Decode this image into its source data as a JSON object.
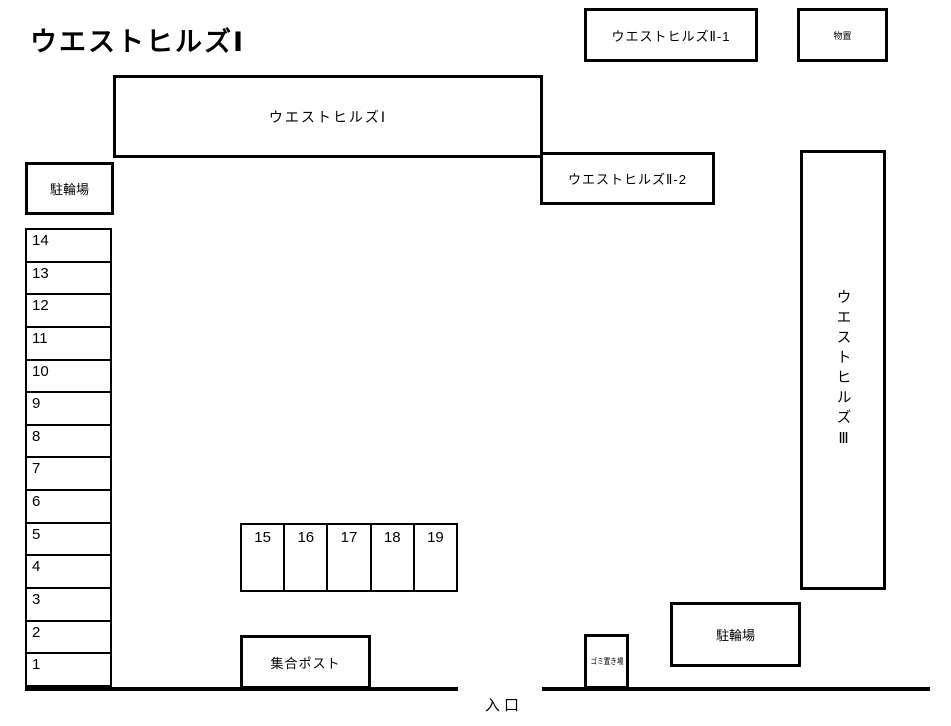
{
  "page": {
    "title": "ウエストヒルズⅠ"
  },
  "buildings": {
    "main": {
      "label": "ウエストヒルズⅠ"
    },
    "annex_2_1": {
      "label": "ウエストヒルズⅡ-1"
    },
    "annex_2_2": {
      "label": "ウエストヒルズⅡ-2"
    },
    "annex_3": {
      "label": "ウエストヒルズⅢ"
    },
    "storage": {
      "label": "物置"
    }
  },
  "facilities": {
    "bicycle_parking_upper": {
      "label": "駐輪場"
    },
    "bicycle_parking_lower": {
      "label": "駐輪場"
    },
    "mail_post": {
      "label": "集合ポスト"
    },
    "garbage": {
      "label": "ゴミ置き場"
    },
    "entrance": {
      "label": "入口"
    }
  },
  "parking": {
    "left_column": [
      "14",
      "13",
      "12",
      "11",
      "10",
      "9",
      "8",
      "7",
      "6",
      "5",
      "4",
      "3",
      "2",
      "1"
    ],
    "middle_row": [
      "15",
      "16",
      "17",
      "18",
      "19"
    ]
  },
  "colors": {
    "line": "#000000",
    "background": "#ffffff",
    "text": "#000000"
  }
}
